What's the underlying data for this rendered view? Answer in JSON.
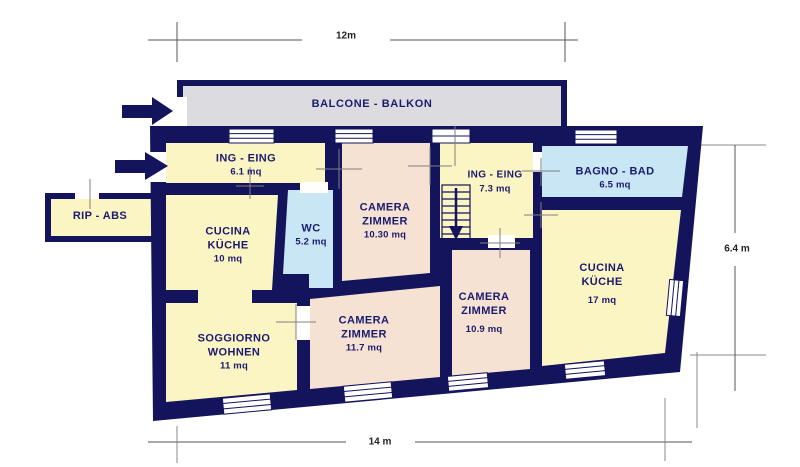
{
  "dimensions": {
    "top": "12m",
    "bottom": "14 m",
    "side": "6.4 m"
  },
  "balcony": {
    "label": "BALCONE - BALKON"
  },
  "annex": {
    "label": "RIP - ABS"
  },
  "rooms": [
    {
      "name": "ING - EING",
      "area": "6.1 mq"
    },
    {
      "name": "CUCINA",
      "name2": "KÜCHE",
      "area": "10 mq"
    },
    {
      "name": "WC",
      "area": "5.2 mq"
    },
    {
      "name": "CAMERA",
      "name2": "ZIMMER",
      "area": "10.30 mq"
    },
    {
      "name": "ING - EING",
      "area": "7.3 mq"
    },
    {
      "name": "BAGNO - BAD",
      "area": "6.5 mq"
    },
    {
      "name": "CUCINA",
      "name2": "KÜCHE",
      "area": "17 mq"
    },
    {
      "name": "CAMERA",
      "name2": "ZIMMER",
      "area": "10.9 mq"
    },
    {
      "name": "CAMERA",
      "name2": "ZIMMER",
      "area": "11.7 mq"
    },
    {
      "name": "SOGGIORNO",
      "name2": "WOHNEN",
      "area": "11 mq"
    }
  ],
  "colors": {
    "wall": "#14145c",
    "room_yellow": "#fbf5c4",
    "room_peach": "#f6e2d2",
    "room_blue": "#c9e6f5",
    "balcony_gray": "#dcdce0",
    "label_navy": "#1b1b6e"
  }
}
